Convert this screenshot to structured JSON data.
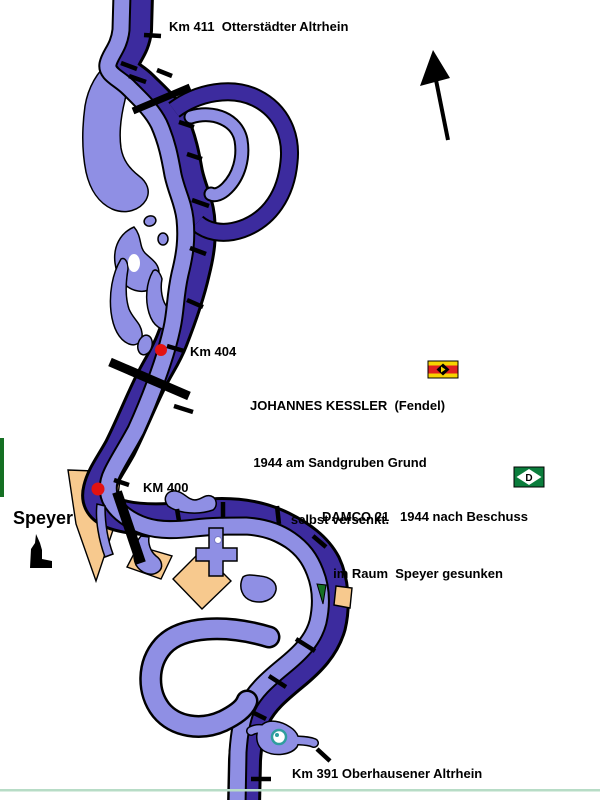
{
  "labels": {
    "km_411": "Km 411  Otterstädter Altrhein",
    "km_404": "Km 404",
    "km_400": "KM 400",
    "km_391": "Km 391 Oberhausener Altrhein",
    "city_speyer": "Speyer"
  },
  "annotations": {
    "johannes_kessler": {
      "line1": "JOHANNES KESSLER  (Fendel)",
      "line2": "1944 am Sandgruben Grund",
      "line3": "selbst versenkt."
    },
    "damco_21": {
      "line1": "DAMCO 21   1944 nach Beschuss",
      "line2": "im Raum  Speyer gesunken",
      "flag_letter": "D"
    }
  },
  "icons": {
    "north_arrow": "north-arrow",
    "city_icon": "speyer-cathedral-icon",
    "kessler_flag": "fendel-house-flag",
    "damco_flag": "damco-house-flag",
    "wreck_marker": "red-dot"
  },
  "colors": {
    "river_light": "#8f8fe4",
    "river_dark": "#3c2b9e",
    "outline_black": "#000000",
    "land_tan": "#f7c98e",
    "forest_green": "#157023",
    "wreck_dot_red": "#e31212",
    "fendel_flag_red": "#e02020",
    "fendel_flag_yellow": "#f6d400",
    "damco_flag_green": "#0b7d3c",
    "island_ring_teal": "#2f9e9e",
    "bottom_border": "#b7dcc6"
  }
}
